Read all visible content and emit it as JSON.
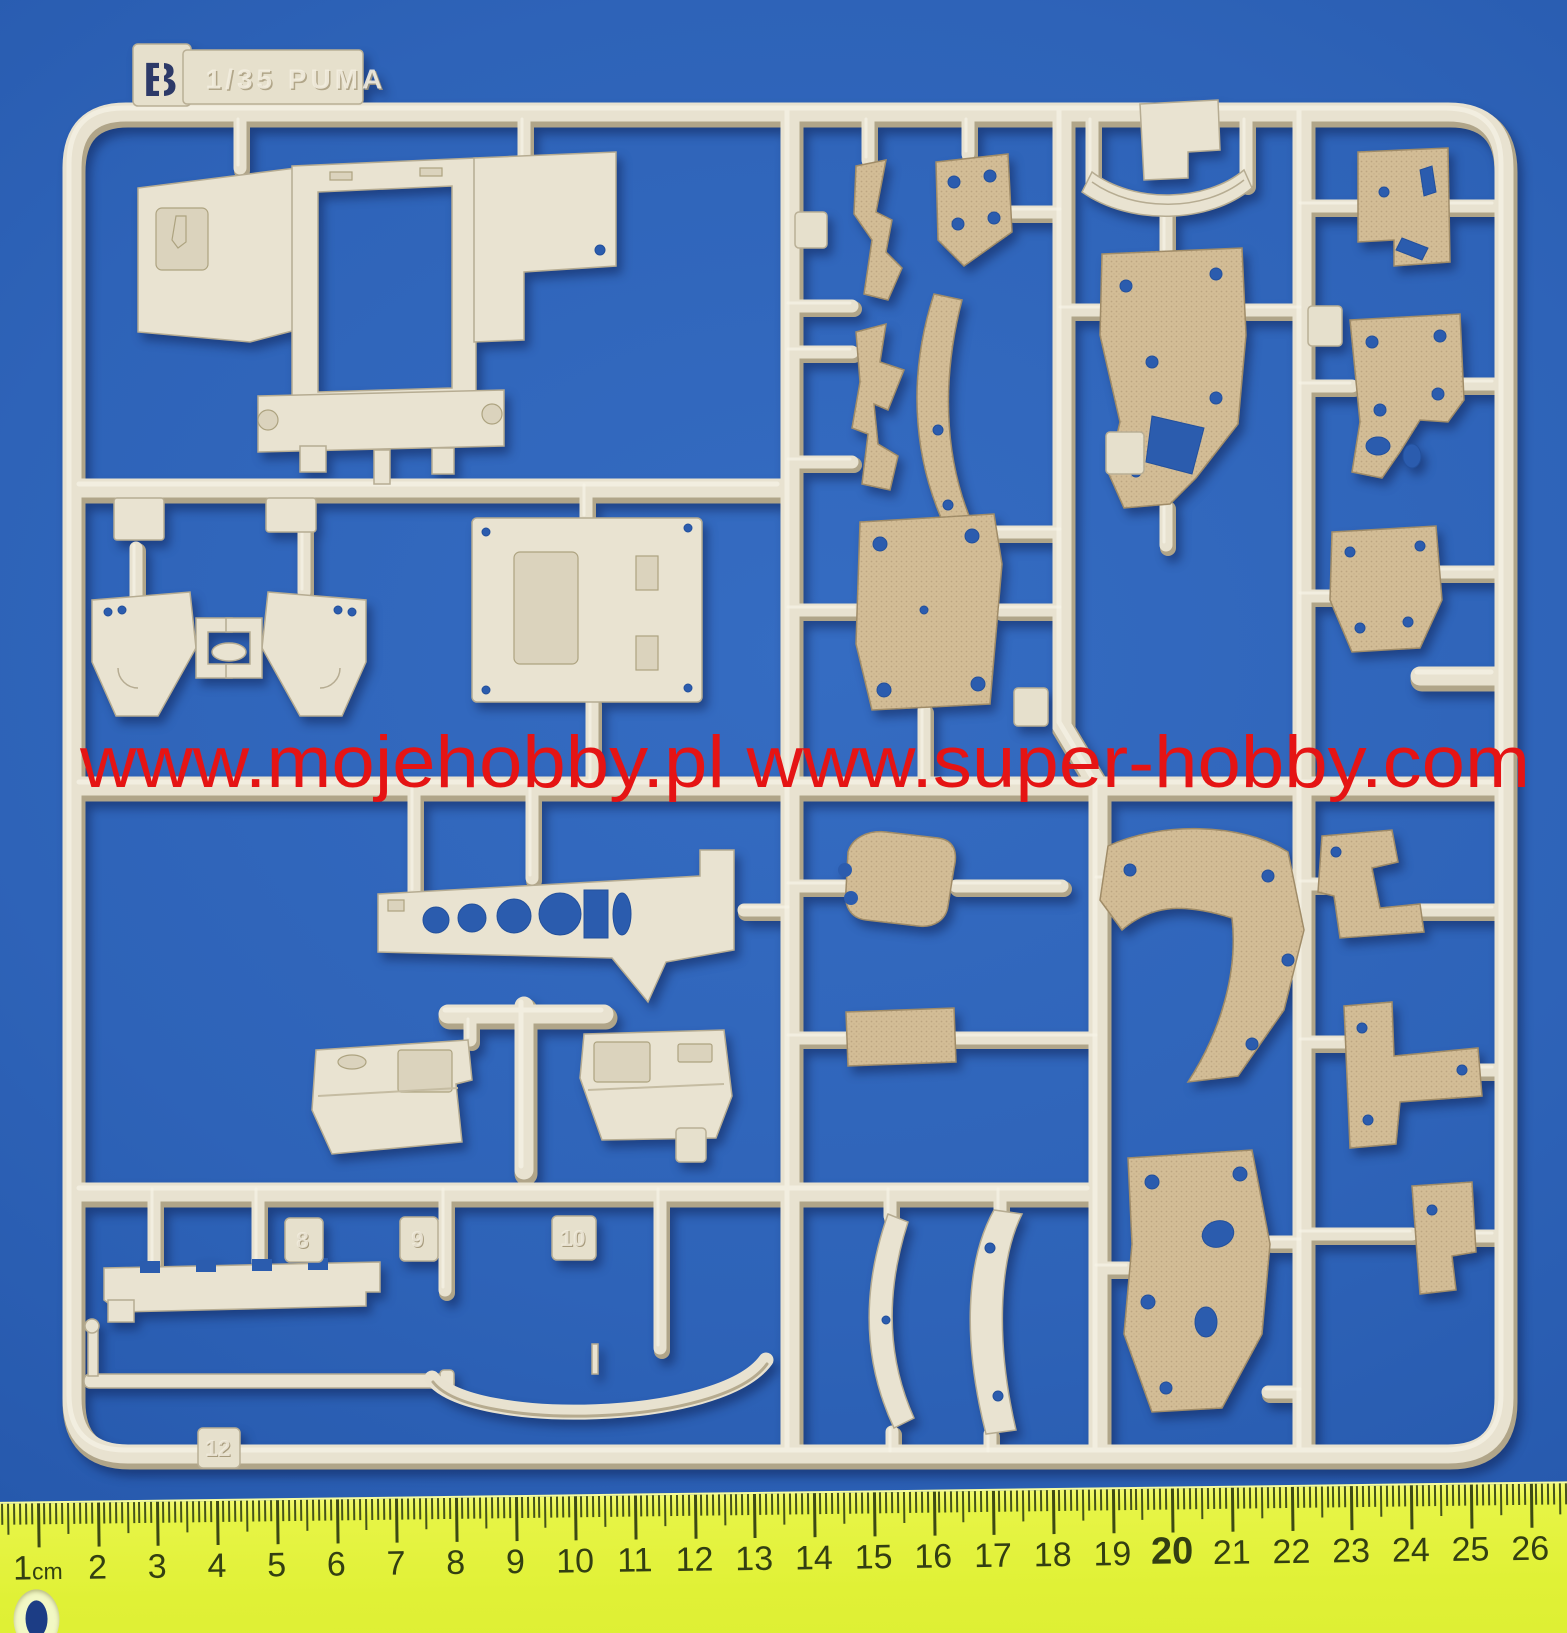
{
  "sprue": {
    "tag": {
      "letter": "B",
      "scale_text": "1/35 PUMA"
    },
    "runner_tag_labels": [
      "8",
      "9",
      "10",
      "12"
    ]
  },
  "watermark": {
    "text": "www.mojehobby.pl www.super-hobby.com",
    "color": "#e51414"
  },
  "ruler": {
    "numbers": [
      "1cm",
      "2",
      "3",
      "4",
      "5",
      "6",
      "7",
      "8",
      "9",
      "10",
      "11",
      "12",
      "13",
      "14",
      "15",
      "16",
      "17",
      "18",
      "19",
      "20",
      "21",
      "22",
      "23",
      "24",
      "25",
      "26"
    ],
    "bold_number": "20",
    "first_cm_x_px": 37,
    "cm_spacing_px": 59.7
  },
  "colors": {
    "background_blue": "#2e63b8",
    "plastic_light": "#e9e3d1",
    "plastic_tan": "#d3bd96",
    "watermark_red": "#e51414",
    "ruler_yellow": "#e0f136",
    "ruler_ink": "#3d4a14",
    "stencil_blue": "#2d3a68"
  }
}
